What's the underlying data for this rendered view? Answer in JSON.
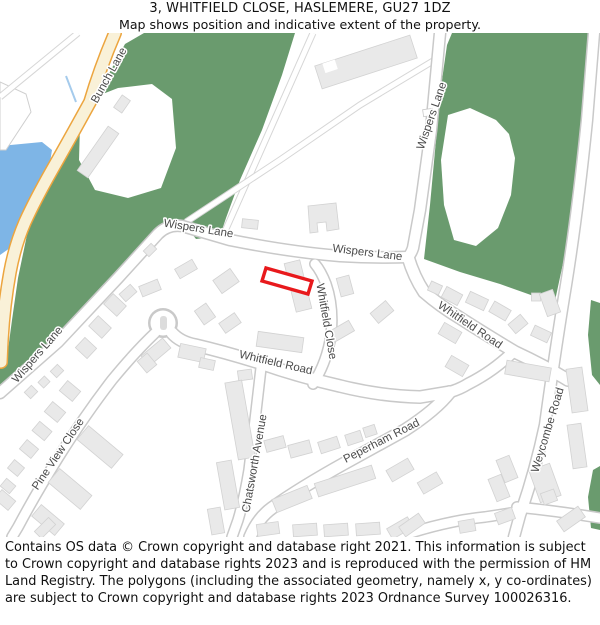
{
  "header": {
    "title": "3, WHITFIELD CLOSE, HASLEMERE, GU27 1DZ",
    "subtitle": "Map shows position and indicative extent of the property."
  },
  "map": {
    "property_address": "3, WHITFIELD CLOSE, HASLEMERE, GU27 1DZ",
    "labels": [
      {
        "text": "Bunch Lane"
      },
      {
        "text": "Wispers Lane"
      },
      {
        "text": "Wispers Lane"
      },
      {
        "text": "Wispers Lane"
      },
      {
        "text": "Wispers Lane"
      },
      {
        "text": "Whitfield Close"
      },
      {
        "text": "Whitfield Road"
      },
      {
        "text": "Whitfield Road"
      },
      {
        "text": "Chatsworth Avenue"
      },
      {
        "text": "Pine View Close"
      },
      {
        "text": "Peperham Road"
      },
      {
        "text": "Weycombe Road"
      }
    ],
    "colors": {
      "woodland": "#6a9b6e",
      "water": "#7eb5e6",
      "stream": "#a5cbec",
      "road_fill": "#ffffff",
      "road_casing": "#c9c9c9",
      "track_casing": "#d6d6d6",
      "primary_road_fill": "#f9f1d8",
      "primary_road_casing": "#eca53f",
      "building_fill": "#e9e9e9",
      "building_stroke": "#d2d2d2",
      "property_outline": "#e8191c",
      "label_color": "#4a4a4a",
      "background": "#ffffff"
    }
  },
  "footer": {
    "text": "Contains OS data © Crown copyright and database right 2021. This information is subject to Crown copyright and database rights 2023 and is reproduced with the permission of HM Land Registry. The polygons (including the associated geometry, namely x, y co-ordinates) are subject to Crown copyright and database rights 2023 Ordnance Survey 100026316."
  }
}
